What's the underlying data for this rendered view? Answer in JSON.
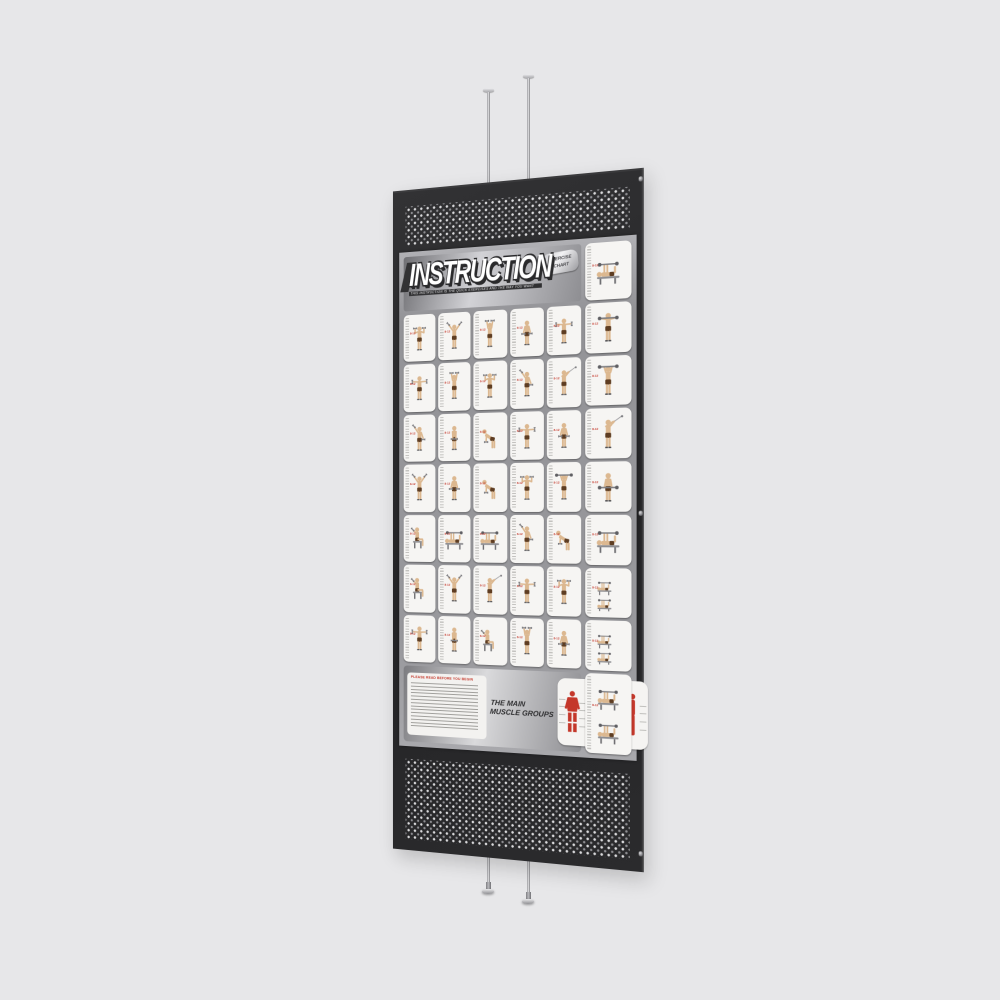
{
  "scene": {
    "background_color": "#e7e7e9"
  },
  "mount": {
    "top_rods": [
      "top-rod-left",
      "top-rod-right"
    ],
    "bottom_rods": [
      "bottom-rod-left",
      "bottom-rod-right"
    ]
  },
  "panel": {
    "color": "#2a2a2c",
    "perforation_dot_color": "#d9d9db",
    "screw_count": 3
  },
  "poster": {
    "header": {
      "title": "INSTRUCTION",
      "subtitle": "THIS INSTRUCTION IS THE QUICK EXERCISES AND THE WAY YOU WANT",
      "badge": {
        "line1": "EXERCISE",
        "line2": "CHART"
      }
    },
    "grid": {
      "columns": 5,
      "rows": 7,
      "reps_marker": "8-12",
      "reps_color": "#c4372a",
      "cells": [
        "press-up",
        "v-raise",
        "overhead",
        "down-hold",
        "t-raise",
        "t-raise",
        "overhead",
        "press-up",
        "single-raise",
        "cable",
        "single-raise",
        "front-raise",
        "bent-over",
        "t-raise",
        "down-hold",
        "v-raise",
        "down-hold",
        "bent-over",
        "press-up",
        "barbell-press",
        "seated",
        "lying-bench",
        "lying-bench",
        "single-raise",
        "bent-over",
        "seated",
        "v-raise",
        "cable",
        "t-raise",
        "press-up",
        "t-raise",
        "front-raise",
        "seated",
        "overhead",
        "down-hold"
      ]
    },
    "side_column": {
      "cells": [
        "lying-bench",
        "barbell-squat",
        "barbell-press",
        "cable",
        "barbell-curl",
        "lying-bench",
        "bench-combo",
        "bench-combo",
        "bench-combo-tall"
      ]
    },
    "footer": {
      "notice_title": "PLEASE READ BEFORE YOU BEGIN",
      "notice_line_count": 9,
      "muscle_title_line1": "THE MAIN",
      "muscle_title_line2": "MUSCLE GROUPS",
      "muscle_color": "#c4372a",
      "figure_views": [
        "front",
        "back",
        "side"
      ]
    }
  },
  "palette": {
    "skin": "#dcb890",
    "shorts": "#5e3d22",
    "equipment": "#8a8a8e",
    "card": "#f6f5f3"
  }
}
